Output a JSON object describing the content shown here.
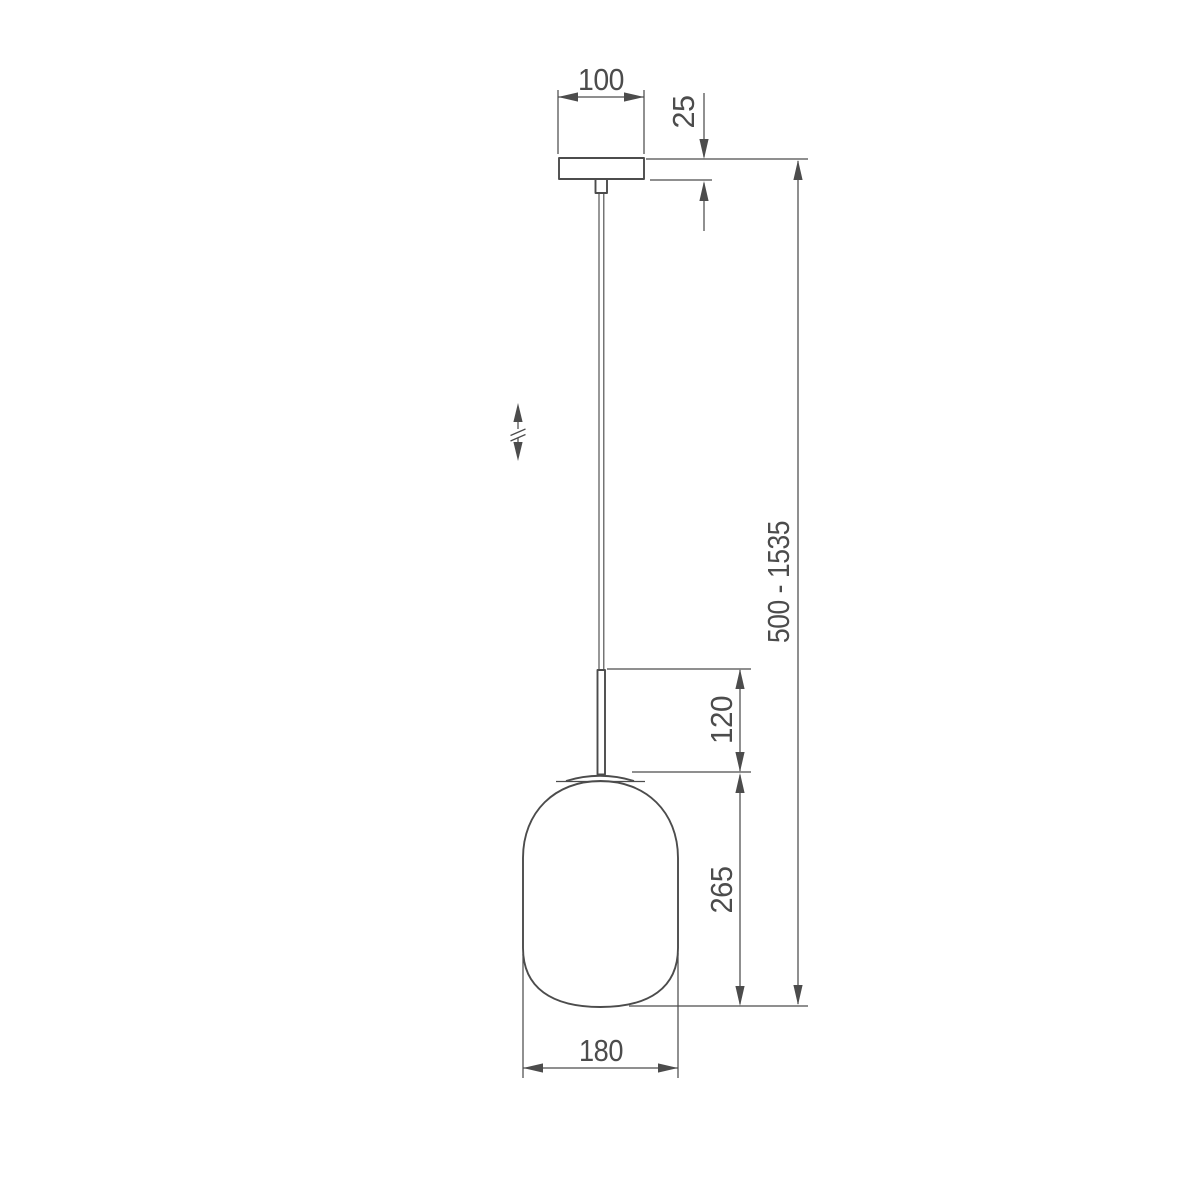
{
  "page": {
    "background": "#ffffff"
  },
  "drawing": {
    "kind": "technical-dimension-drawing",
    "subject": "pendant lamp with capsule glass shade",
    "line_color": "#4c4c4c",
    "labels": {
      "canopy_width": "100",
      "canopy_height": "25",
      "overall_height": "500 - 1535",
      "stem_length": "120",
      "shade_height": "265",
      "shade_width": "180"
    }
  }
}
